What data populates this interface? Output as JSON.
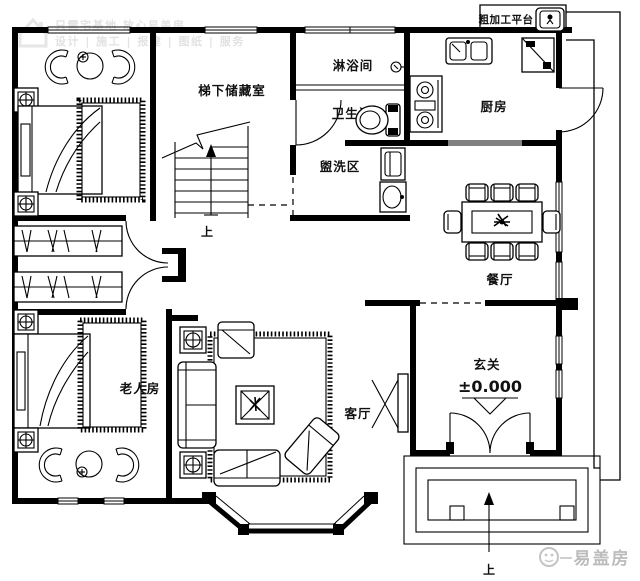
{
  "title": "二层户型平面图",
  "watermark_top": {
    "line1": "只需宅基地 放心易盖房",
    "line2": "设计 | 施工 | 报建 | 图纸 | 服务"
  },
  "watermark_bottom": {
    "brand": "易盖房"
  },
  "rooms": {
    "storage": "梯下储藏室",
    "shower": "淋浴间",
    "toilet": "卫生间",
    "wash": "盥洗区",
    "kitchen": "厨房",
    "platform": "粗加工平台",
    "dining": "餐厅",
    "entry": "玄关",
    "entry_level": "±0.000",
    "living": "客厅",
    "elder": "老人房",
    "stairs_up": "上",
    "porch_up": "上"
  },
  "colors": {
    "wall": "#000000",
    "background": "#ffffff",
    "watermark_light": "#e2e2e2",
    "watermark_brand": "#bcbcbc"
  }
}
